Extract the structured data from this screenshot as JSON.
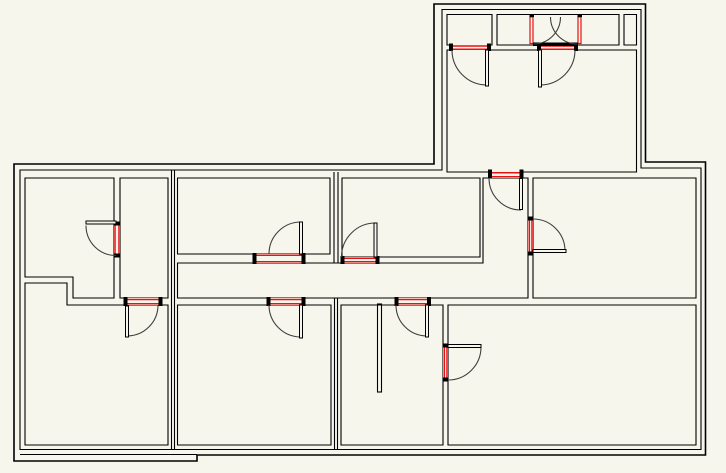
{
  "canvas": {
    "width": 726,
    "height": 473,
    "background": "#f7f6ec"
  },
  "palette": {
    "wall": "#000000",
    "opening_red": "#e81111",
    "arc": "#3f3f3f",
    "fill": "#f7f6ec",
    "cap": "#000000"
  },
  "plan": {
    "exterior": {
      "outer": {
        "name": "exterior-outer-outline",
        "stroke_width": 1.6,
        "points": [
          [
            14,
            164
          ],
          [
            434,
            164
          ],
          [
            434,
            4
          ],
          [
            645.5,
            4
          ],
          [
            645.5,
            162
          ],
          [
            705.5,
            162
          ],
          [
            705.5,
            455
          ],
          [
            197,
            455
          ],
          [
            197,
            461
          ],
          [
            14,
            461
          ]
        ]
      },
      "inner": {
        "name": "exterior-inner-outline",
        "stroke_width": 1.1,
        "points": [
          [
            20,
            170
          ],
          [
            442,
            170
          ],
          [
            442,
            9.5
          ],
          [
            641,
            9.5
          ],
          [
            641,
            168
          ],
          [
            701,
            168
          ],
          [
            701,
            449.5
          ],
          [
            20,
            449.5
          ]
        ]
      }
    },
    "rooms": [
      {
        "name": "room-upper-left",
        "points": [
          [
            25,
            178
          ],
          [
            114,
            178
          ],
          [
            114,
            298
          ],
          [
            73,
            298
          ],
          [
            73,
            277
          ],
          [
            25,
            277
          ]
        ]
      },
      {
        "name": "room-left-closet",
        "points": [
          [
            120,
            178
          ],
          [
            168,
            178
          ],
          [
            168,
            298
          ],
          [
            120,
            298
          ]
        ]
      },
      {
        "name": "room-lower-left",
        "points": [
          [
            25,
            283
          ],
          [
            67,
            283
          ],
          [
            67,
            305
          ],
          [
            168,
            305
          ],
          [
            168,
            445
          ],
          [
            25,
            445
          ]
        ]
      },
      {
        "name": "room-middle-top",
        "points": [
          [
            177.5,
            178
          ],
          [
            330,
            178
          ],
          [
            330,
            254
          ],
          [
            177.5,
            254
          ]
        ]
      },
      {
        "name": "room-middle-top-2",
        "points": [
          [
            342,
            178
          ],
          [
            480,
            178
          ],
          [
            480,
            257
          ],
          [
            342,
            257
          ]
        ]
      },
      {
        "name": "corridor-and-hall",
        "points": [
          [
            177.5,
            263
          ],
          [
            483,
            263
          ],
          [
            483,
            178
          ],
          [
            528,
            178
          ],
          [
            528,
            298
          ],
          [
            177.5,
            298
          ]
        ]
      },
      {
        "name": "room-right-middle",
        "points": [
          [
            533,
            178
          ],
          [
            696,
            178
          ],
          [
            696,
            298
          ],
          [
            533,
            298
          ]
        ]
      },
      {
        "name": "room-bottom-middle",
        "points": [
          [
            177.5,
            305
          ],
          [
            331,
            305
          ],
          [
            331,
            445
          ],
          [
            177.5,
            445
          ]
        ]
      },
      {
        "name": "room-bottom-center",
        "points": [
          [
            341,
            305
          ],
          [
            443,
            305
          ],
          [
            443,
            445
          ],
          [
            341,
            445
          ]
        ]
      },
      {
        "name": "room-bottom-right",
        "points": [
          [
            448,
            305
          ],
          [
            696,
            305
          ],
          [
            696,
            445
          ],
          [
            448,
            445
          ]
        ]
      },
      {
        "name": "wing-closet-left",
        "points": [
          [
            447,
            14.5
          ],
          [
            492,
            14.5
          ],
          [
            492,
            45
          ],
          [
            447,
            45
          ]
        ]
      },
      {
        "name": "wing-closet-middle",
        "points": [
          [
            497,
            14.5
          ],
          [
            619,
            14.5
          ],
          [
            619,
            45
          ],
          [
            497,
            45
          ]
        ]
      },
      {
        "name": "wing-closet-right",
        "points": [
          [
            624,
            14.5
          ],
          [
            636.5,
            14.5
          ],
          [
            636.5,
            45
          ],
          [
            624,
            45
          ]
        ]
      },
      {
        "name": "wing-main-room",
        "points": [
          [
            447,
            50
          ],
          [
            636.5,
            50
          ],
          [
            636.5,
            172
          ],
          [
            447,
            172
          ]
        ]
      }
    ],
    "extra_walls": [
      {
        "name": "left-divider-line-a",
        "x1": 171.5,
        "y1": 170,
        "x2": 171.5,
        "y2": 449.5
      },
      {
        "name": "left-divider-line-b",
        "x1": 174.5,
        "y1": 170,
        "x2": 174.5,
        "y2": 449.5
      },
      {
        "name": "mid-divider-top-a",
        "x1": 334,
        "y1": 172,
        "x2": 334,
        "y2": 263
      },
      {
        "name": "mid-divider-top-b",
        "x1": 338,
        "y1": 172,
        "x2": 338,
        "y2": 263
      },
      {
        "name": "mid-divider-bottom-a",
        "x1": 334.5,
        "y1": 298,
        "x2": 334.5,
        "y2": 449.5
      },
      {
        "name": "mid-divider-bottom-b",
        "x1": 337.5,
        "y1": 298,
        "x2": 337.5,
        "y2": 449.5
      },
      {
        "name": "bottom-left-extra-line",
        "x1": 20,
        "y1": 454.5,
        "x2": 197,
        "y2": 454.5
      }
    ],
    "partitions": [
      {
        "name": "stub-wall-bottom-center",
        "x": 377.5,
        "y": 304,
        "w": 4,
        "h": 88
      }
    ],
    "openings": [
      {
        "name": "opening-wing-closet-left",
        "fill": [
          449.5,
          44,
          41,
          6.5
        ],
        "red": [
          [
            452.5,
            46,
            487.5,
            46
          ],
          [
            452.5,
            49.3,
            487.5,
            49.3
          ]
        ],
        "caps": [
          [
            449,
            43.5,
            4,
            7.5
          ],
          [
            487,
            43.5,
            4,
            7.5
          ]
        ]
      },
      {
        "name": "opening-wing-closet-middle",
        "fill": [
          537.5,
          44,
          40,
          6.5
        ],
        "red": [
          [
            540.5,
            46,
            574.5,
            46
          ],
          [
            540.5,
            49.3,
            574.5,
            49.3
          ]
        ],
        "caps": [
          [
            537,
            43.5,
            4,
            7.5
          ],
          [
            574,
            43.5,
            4,
            7.5
          ]
        ]
      },
      {
        "name": "opening-wing-to-hall",
        "fill": [
          488.5,
          170,
          34.5,
          8
        ],
        "red": [
          [
            491.5,
            172.8,
            519.5,
            172.8
          ],
          [
            491.5,
            176.8,
            519.5,
            176.8
          ]
        ],
        "caps": [
          [
            488,
            169.5,
            4,
            9
          ],
          [
            519.5,
            169.5,
            4,
            9
          ]
        ]
      },
      {
        "name": "opening-upper-left-rooms",
        "fill": [
          114,
          222,
          6,
          35
        ],
        "red": [
          [
            115,
            225.5,
            115,
            253.5
          ],
          [
            119,
            225.5,
            119,
            253.5
          ]
        ],
        "caps": [
          [
            113.5,
            221.5,
            7,
            4
          ],
          [
            113.5,
            253.5,
            7,
            4
          ]
        ]
      },
      {
        "name": "opening-left-closet-to-lower",
        "fill": [
          124,
          298,
          38,
          7
        ],
        "red": [
          [
            127,
            299.5,
            159,
            299.5
          ],
          [
            127,
            303.8,
            159,
            303.8
          ]
        ],
        "caps": [
          [
            123.5,
            297,
            4,
            9
          ],
          [
            158.5,
            297,
            4,
            9
          ]
        ]
      },
      {
        "name": "opening-middle-top-to-corridor",
        "fill": [
          253,
          254,
          52,
          9
        ],
        "red": [
          [
            256.5,
            255.3,
            301.5,
            255.3
          ],
          [
            256.5,
            261.8,
            301.5,
            261.8
          ]
        ],
        "caps": [
          [
            252.5,
            253,
            4,
            11
          ],
          [
            301.5,
            253,
            4,
            11
          ]
        ]
      },
      {
        "name": "opening-middle-top2-to-corridor",
        "fill": [
          341,
          257,
          38,
          6
        ],
        "red": [
          [
            344.5,
            258.3,
            375.5,
            258.3
          ],
          [
            344.5,
            261.8,
            375.5,
            261.8
          ]
        ],
        "caps": [
          [
            340.5,
            256,
            4,
            8
          ],
          [
            375.5,
            256,
            4,
            8
          ]
        ]
      },
      {
        "name": "opening-corridor-to-bottom-middle",
        "fill": [
          267,
          298,
          38,
          7
        ],
        "red": [
          [
            270.5,
            299.5,
            301.5,
            299.5
          ],
          [
            270.5,
            303.8,
            301.5,
            303.8
          ]
        ],
        "caps": [
          [
            266.5,
            297,
            4,
            9
          ],
          [
            301.5,
            297,
            4,
            9
          ]
        ]
      },
      {
        "name": "opening-corridor-to-bottom-center",
        "fill": [
          394.5,
          298,
          36.5,
          7
        ],
        "red": [
          [
            398.5,
            299.5,
            427,
            299.5
          ],
          [
            398.5,
            303.8,
            427,
            303.8
          ]
        ],
        "caps": [
          [
            394.5,
            297,
            4,
            9
          ],
          [
            427,
            297,
            4,
            9
          ]
        ]
      },
      {
        "name": "opening-hall-to-right-room",
        "fill": [
          528,
          217,
          5,
          38
        ],
        "red": [
          [
            529.3,
            220.5,
            529.3,
            251.5
          ],
          [
            532,
            220.5,
            532,
            251.5
          ]
        ],
        "caps": [
          [
            527.5,
            216.5,
            6,
            4
          ],
          [
            527.5,
            251.5,
            6,
            4
          ]
        ]
      },
      {
        "name": "opening-center-to-bottom-right",
        "fill": [
          443,
          343.5,
          5,
          38
        ],
        "red": [
          [
            444.3,
            347.5,
            444.3,
            377.5
          ],
          [
            447,
            347.5,
            447,
            377.5
          ]
        ],
        "caps": [
          [
            442.5,
            343.5,
            6,
            4
          ],
          [
            442.5,
            377.5,
            6,
            4
          ]
        ]
      }
    ],
    "double_door_unit": {
      "name": "entry-double-door-unit",
      "jambs": [
        {
          "name": "entry-jamb-left",
          "x": 530,
          "y": 17,
          "w": 3,
          "h": 26.5
        },
        {
          "name": "entry-jamb-right",
          "x": 578,
          "y": 17,
          "w": 3,
          "h": 26.5
        }
      ],
      "jamb_caps": [
        [
          529.5,
          14,
          4.5,
          3
        ],
        [
          577.5,
          14,
          4.5,
          3
        ]
      ],
      "threshold": {
        "name": "entry-threshold",
        "x": 533,
        "y": 42.5,
        "w": 45,
        "h": 3.5
      },
      "arcs": [
        {
          "name": "entry-door-arc-left",
          "cx": 533.5,
          "cy": 17,
          "r": 27,
          "a0": 90,
          "a1": 0
        },
        {
          "name": "entry-door-arc-right",
          "cx": 577.5,
          "cy": 17,
          "r": 27,
          "a0": 90,
          "a1": 180
        }
      ]
    },
    "doors": [
      {
        "name": "door-wing-closet-left",
        "leaf": [
          485.5,
          50,
          3,
          36
        ],
        "arc": {
          "cx": 487,
          "cy": 50,
          "r": 35,
          "a0": 180,
          "a1": 90
        }
      },
      {
        "name": "door-wing-closet-middle",
        "leaf": [
          538.5,
          50,
          3,
          37
        ],
        "arc": {
          "cx": 540,
          "cy": 50,
          "r": 35,
          "a0": 0,
          "a1": 90
        }
      },
      {
        "name": "door-wing-to-hall",
        "leaf": [
          519.5,
          178.5,
          3,
          31
        ],
        "arc": {
          "cx": 521,
          "cy": 178,
          "r": 32,
          "a0": 180,
          "a1": 90
        }
      },
      {
        "name": "door-upper-left-rooms",
        "leaf": [
          86,
          221,
          30,
          3
        ],
        "arc": {
          "cx": 116,
          "cy": 225.5,
          "r": 30,
          "a0": 180,
          "a1": 90
        }
      },
      {
        "name": "door-left-closet-to-lower",
        "leaf": [
          125.5,
          306,
          3,
          31
        ],
        "arc": {
          "cx": 127,
          "cy": 305,
          "r": 31,
          "a0": 0,
          "a1": 90
        }
      },
      {
        "name": "door-middle-top",
        "leaf": [
          299.5,
          222,
          3,
          32
        ],
        "arc": {
          "cx": 301,
          "cy": 254,
          "r": 32,
          "a0": 180,
          "a1": 270
        }
      },
      {
        "name": "door-middle-top-2",
        "leaf": [
          374,
          223,
          3,
          34
        ],
        "arc": {
          "cx": 375.5,
          "cy": 257,
          "r": 34,
          "a0": 180,
          "a1": 270
        }
      },
      {
        "name": "door-bottom-middle",
        "leaf": [
          299.5,
          305,
          3,
          33
        ],
        "arc": {
          "cx": 301,
          "cy": 305,
          "r": 32,
          "a0": 180,
          "a1": 90
        }
      },
      {
        "name": "door-bottom-center",
        "leaf": [
          425.5,
          305,
          3,
          32
        ],
        "arc": {
          "cx": 427,
          "cy": 305,
          "r": 31,
          "a0": 180,
          "a1": 90
        }
      },
      {
        "name": "door-right-room",
        "leaf": [
          533,
          249.5,
          33,
          3
        ],
        "arc": {
          "cx": 533,
          "cy": 251,
          "r": 32,
          "a0": 270,
          "a1": 0
        }
      },
      {
        "name": "door-bottom-right",
        "leaf": [
          448,
          344.5,
          33,
          3
        ],
        "arc": {
          "cx": 448,
          "cy": 347,
          "r": 33,
          "a0": 0,
          "a1": 90
        }
      }
    ]
  }
}
